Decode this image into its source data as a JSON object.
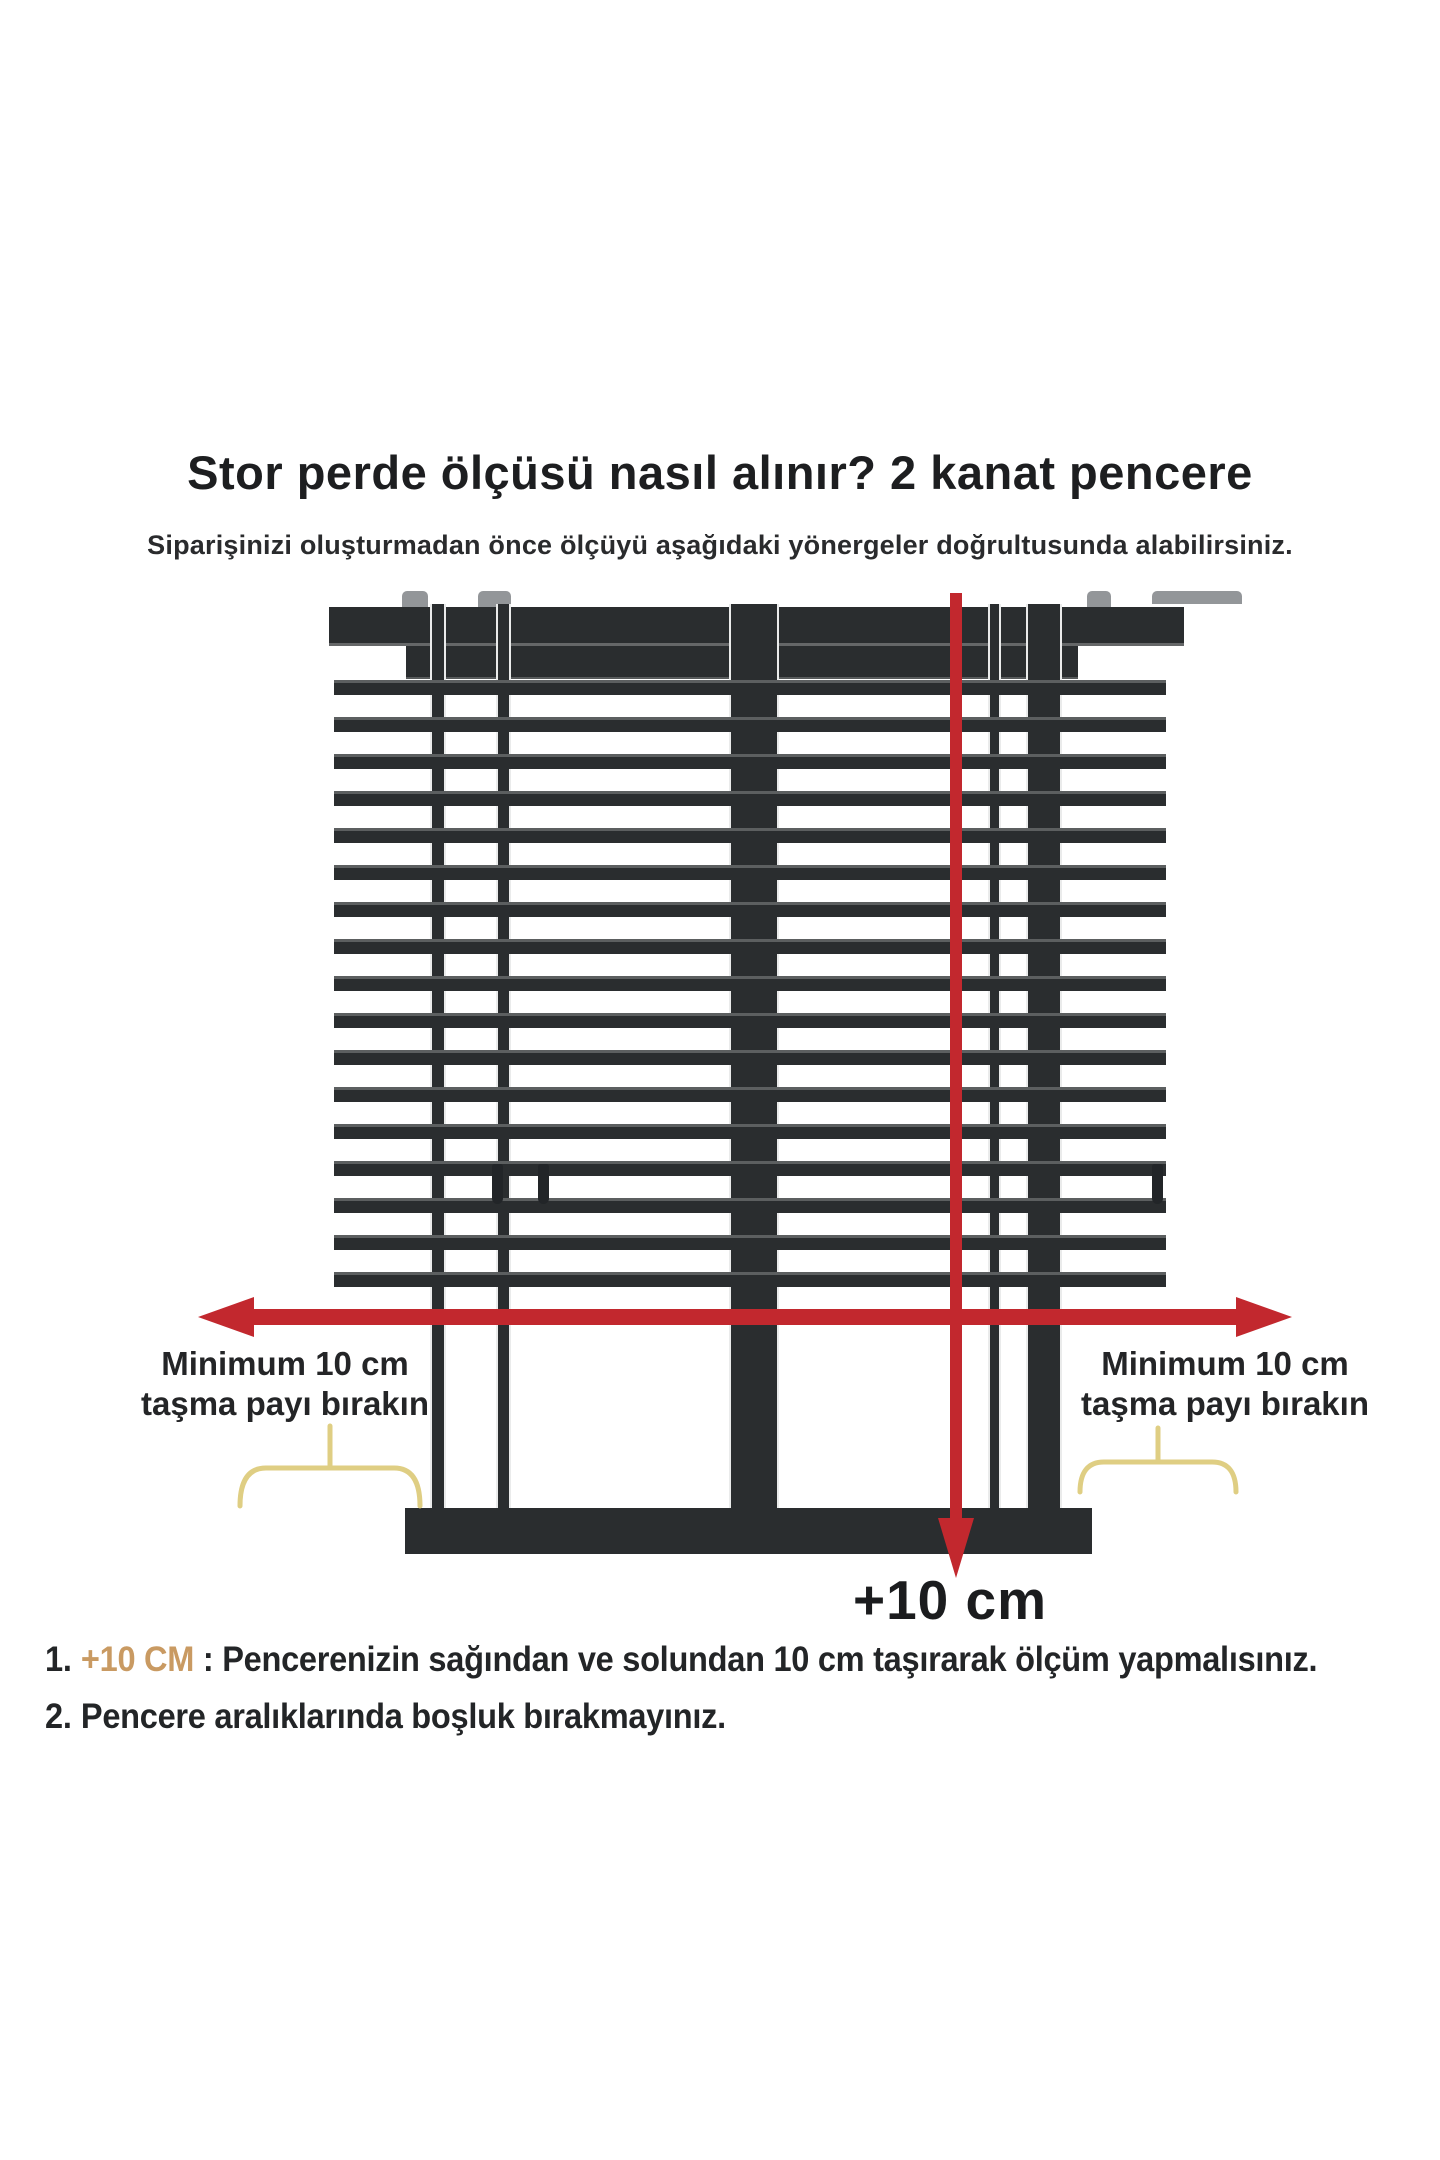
{
  "header": {
    "title": "Stor perde ölçüsü nasıl alınır? 2 kanat pencere",
    "subtitle": "Siparişinizi oluşturmadan önce ölçüyü aşağıdaki yönergeler doğrultusunda alabilirsiniz."
  },
  "diagram": {
    "left_label": {
      "line1": "Minimum 10 cm",
      "line2": "taşma payı bırakın"
    },
    "right_label": {
      "line1": "Minimum 10 cm",
      "line2": "taşma payı bırakın"
    },
    "bottom_arrow_label": "+10 cm",
    "blind": {
      "slat_count": 17
    },
    "colors": {
      "frame_dark": "#2a2d2f",
      "arrow_red": "#c2282e",
      "bracket_yellow": "#dfce83",
      "highlight_tan": "#c99a62"
    }
  },
  "notes": [
    {
      "num": "1.",
      "highlight": "+10 CM",
      "sep": " : ",
      "text": "Pencerenizin sağından ve solundan 10 cm taşırarak ölçüm yapmalısınız."
    },
    {
      "num": "2.",
      "highlight": "",
      "sep": "",
      "text": "Pencere aralıklarında boşluk bırakmayınız."
    }
  ]
}
